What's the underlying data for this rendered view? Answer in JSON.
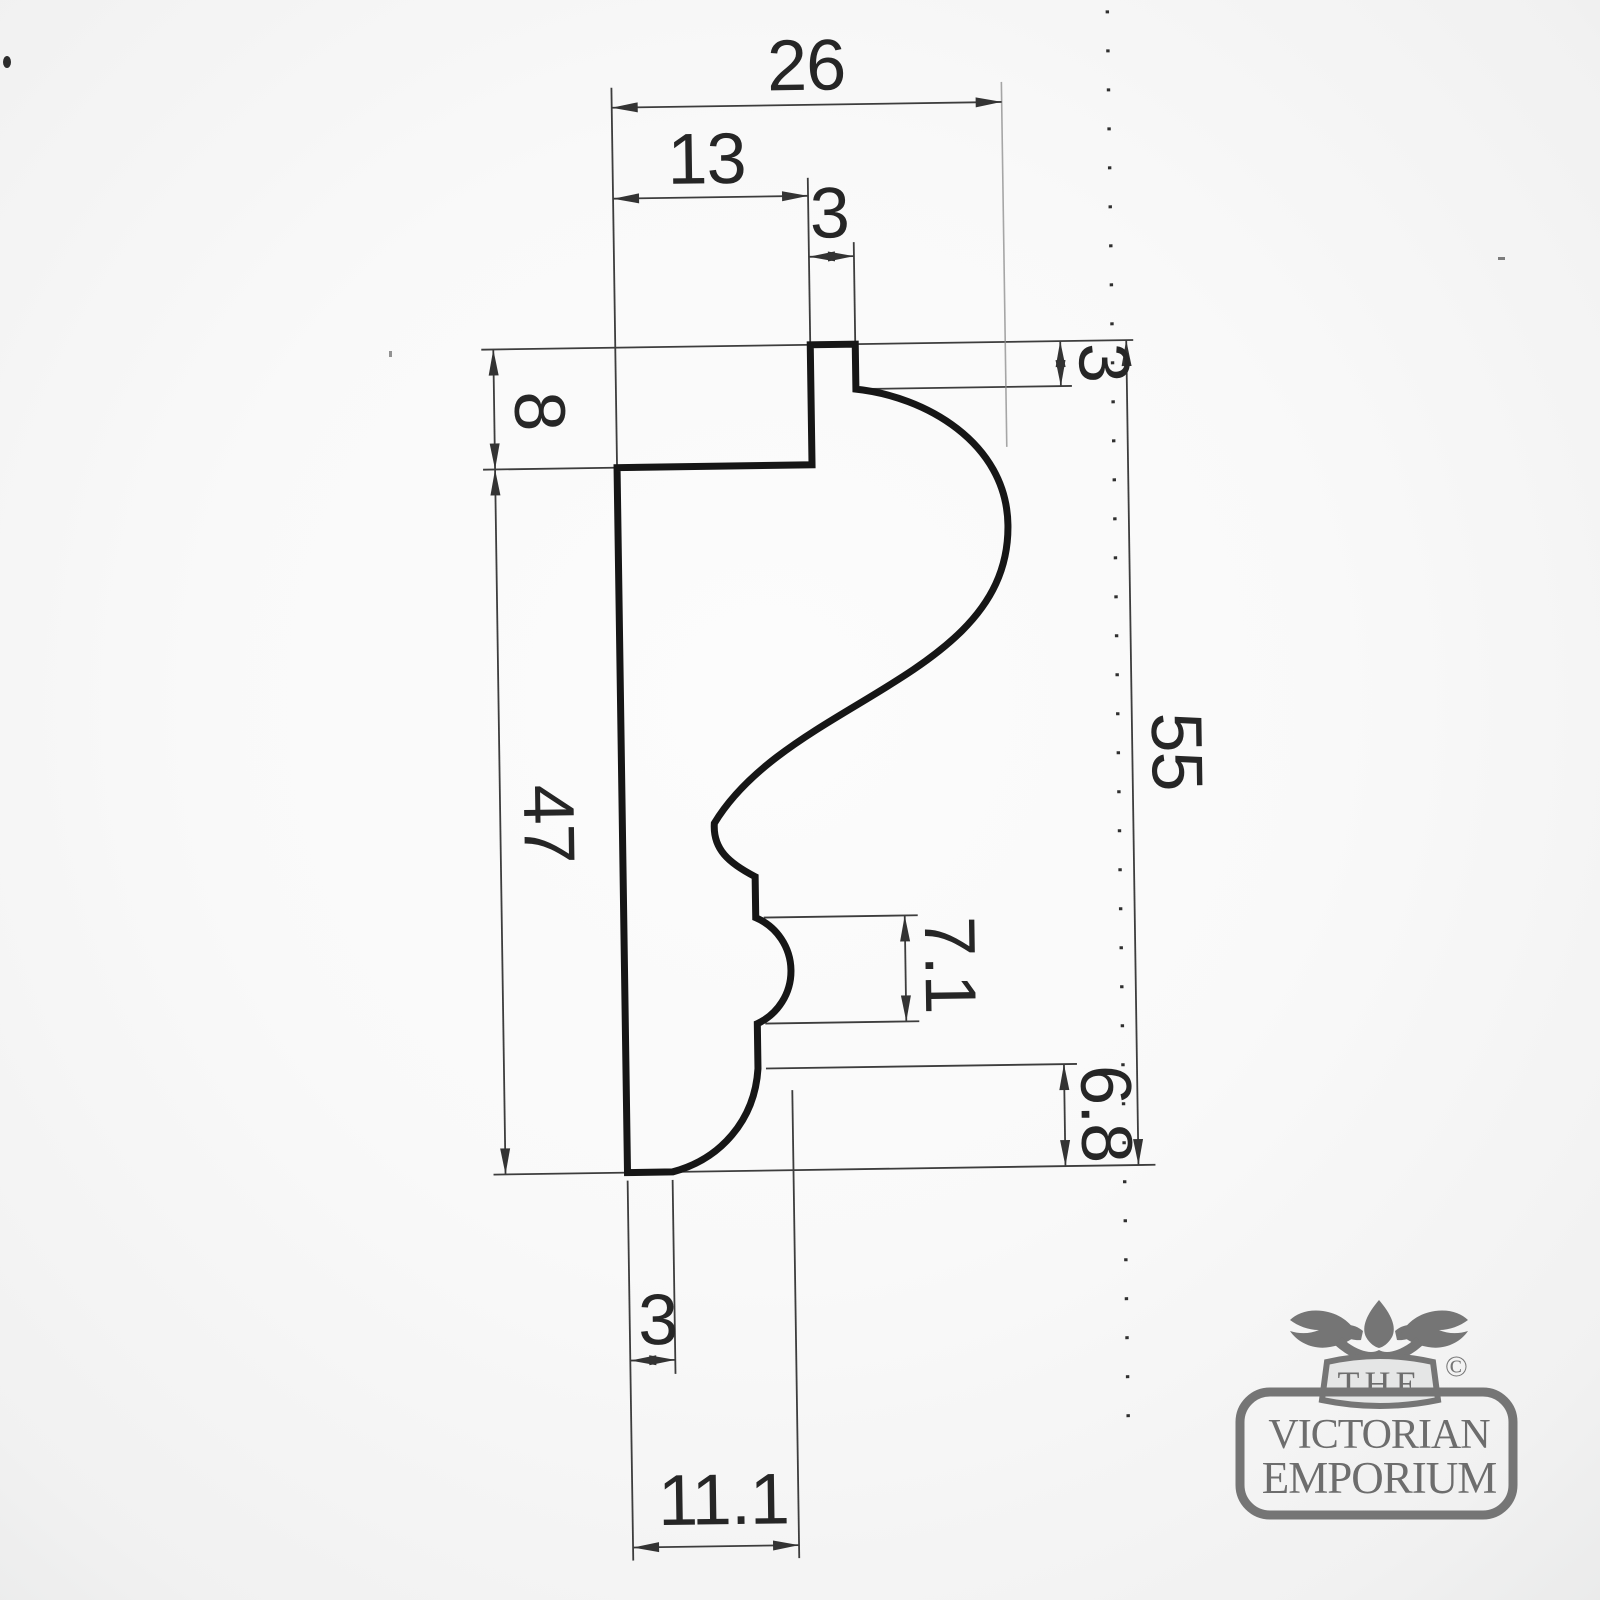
{
  "drawing": {
    "title": "moulding-profile-section",
    "dims": {
      "overall_width": "26",
      "upper_width": "13",
      "tab_width": "3",
      "top_step_height": "8",
      "left_height": "47",
      "right_step_height": "3",
      "overall_height": "55",
      "bead_height": "7.1",
      "base_height": "6.8",
      "base_width": "3",
      "bead_offset": "11.1"
    }
  },
  "logo": {
    "the": "THE",
    "copyright": "©",
    "line1": "VICTORIAN",
    "line2": "EMPORIUM"
  },
  "colors": {
    "profile_line": "#161616",
    "dimension_line": "#3d3d3d",
    "dimension_text": "#262626",
    "logo_gray": "#757575",
    "paper_center": "#fcfcfc",
    "paper_edge": "#caccca"
  }
}
